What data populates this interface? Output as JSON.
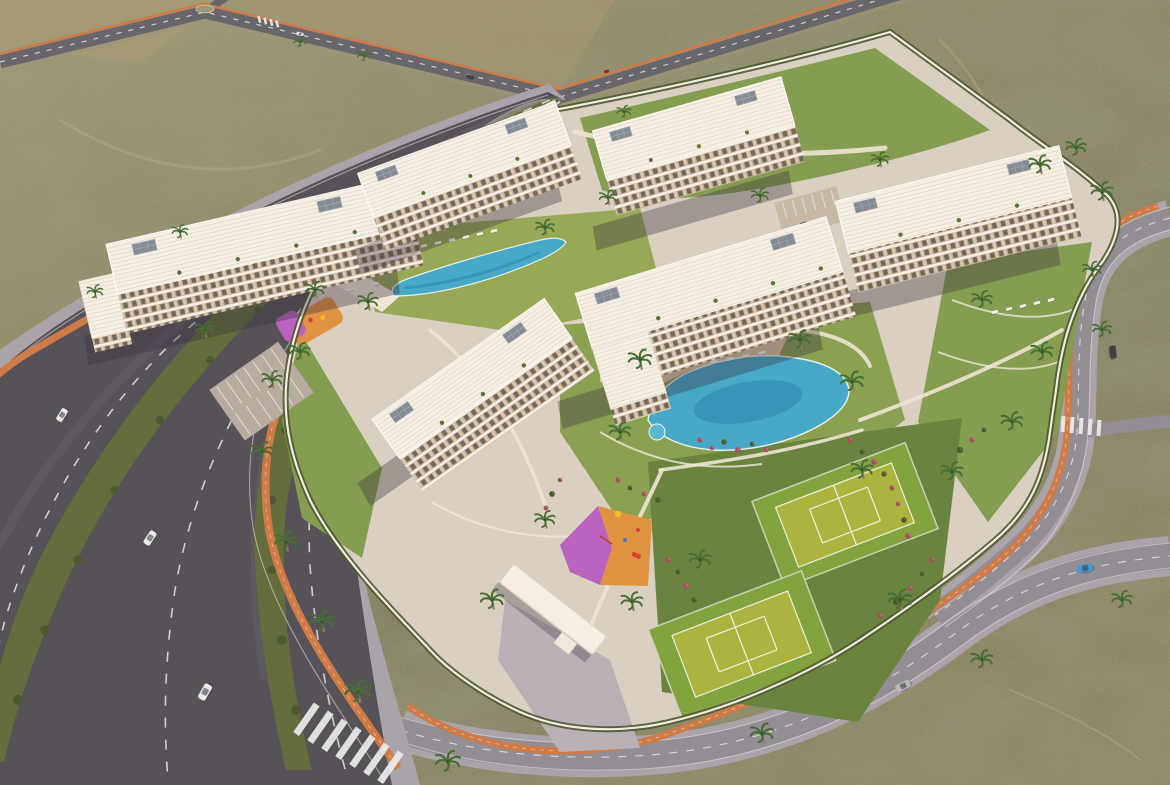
{
  "scene": {
    "type": "aerial-architectural-render",
    "description": "Bird's-eye 3D render of a gated residential resort complex with white apartment blocks, two swimming pools, two tennis courts, playgrounds and gardens, surrounded by desert scrubland and boulevards with orange bike lanes",
    "setting": "desert scrubland",
    "time_of_day": "late afternoon"
  },
  "palette": {
    "terrain": "#77755a",
    "terrain_light": "#a09a78",
    "terrain_dark": "#585a40",
    "trail": "#b5aa83",
    "asphalt_dark": "#504e56",
    "asphalt_mid": "#63636b",
    "asphalt_light": "#8f8b96",
    "sidewalk": "#a7a2ad",
    "bike_path": "#cd7845",
    "road_line": "#e8e8e8",
    "pavement": "#d8d1c5",
    "walkway": "#ece5d4",
    "wall_white": "#f3eee5",
    "lawn": "#7f9c4f",
    "lawn_bright": "#93a855",
    "lawn_dark": "#64823e",
    "pool_water": "#3fa9c9",
    "pool_deep": "#1f7fae",
    "pool_rim": "#eef7f9",
    "deck_tan": "#d9c49e",
    "deck_white": "#efe9dc",
    "building_white": "#f7f4ed",
    "building_shade": "#d8d1c6",
    "balcony_tan": "#c4b29a",
    "window_dark": "#6d6557",
    "solar_panel": "#7e8996",
    "court_green": "#7da23c",
    "court_inner": "#a9b43e",
    "playground_orange": "#e0913f",
    "playground_purple": "#b85fc2",
    "hedge": "#44552e",
    "palm_green": "#3f6b33",
    "palm_trunk": "#8a7a5c",
    "flower_red": "#a04a5e",
    "flower_pink": "#c06878",
    "shadow": "rgba(45,40,60,0.35)",
    "car_white": "#ecedef",
    "car_silver": "#b9b9bd",
    "car_blue": "#3a9ad4",
    "car_dark": "#3c3c44"
  },
  "inventory": {
    "apartment_buildings": 6,
    "building_floors": 4,
    "swimming_pools": 2,
    "tennis_courts": 2,
    "playgrounds": 2,
    "parking_lots": 2,
    "entrance_gates": 1,
    "crosswalks": 3,
    "traffic_islands": 1,
    "sun_loungers": "rows beside both pools",
    "cars": [
      {
        "color": "white",
        "location": "boulevard"
      },
      {
        "color": "white",
        "location": "boulevard"
      },
      {
        "color": "white",
        "location": "boulevard"
      },
      {
        "color": "silver",
        "location": "bottom road"
      },
      {
        "color": "blue",
        "location": "bottom road"
      },
      {
        "color": "dark",
        "location": "right road"
      },
      {
        "color": "white",
        "location": "top road"
      },
      {
        "color": "dark",
        "location": "top road"
      }
    ]
  }
}
